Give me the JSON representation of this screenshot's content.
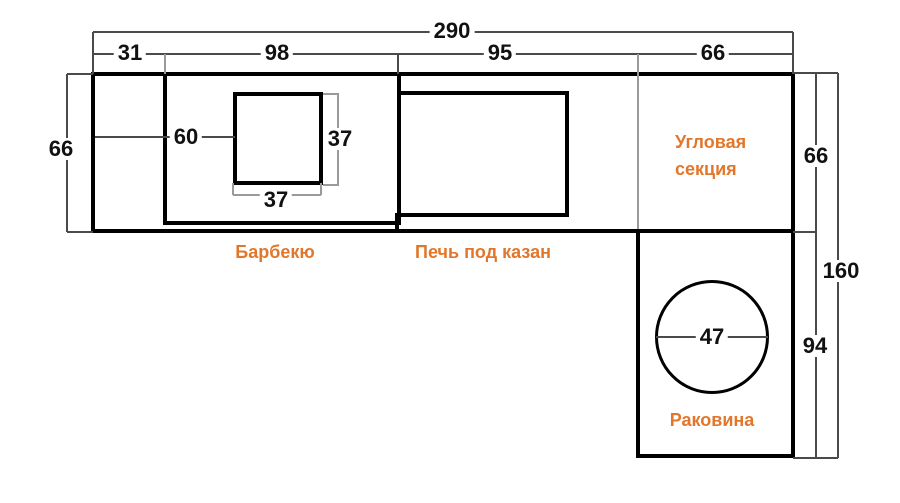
{
  "diagram": {
    "kind": "outdoor-kitchen-plan",
    "dims": {
      "total_width": "290",
      "left_section_width": "31",
      "barbecue_width": "98",
      "stove_width": "95",
      "corner_width": "66",
      "counter_depth": "66",
      "hole_offset_from_left": "60",
      "hole_side_vertical": "37",
      "hole_side_horizontal": "37",
      "corner_depth": "66",
      "right_total_height": "160",
      "sink_section_height": "94",
      "sink_hole_diameter": "47"
    },
    "labels": {
      "barbecue": "Барбекю",
      "stove": "Печь под казан",
      "corner_line1": "Угловая",
      "corner_line2": "секция",
      "sink": "Раковина"
    },
    "colors": {
      "accent_orange": "#E2772B",
      "structure_black": "#000000",
      "dim_line_dark": "#4a4a4a",
      "dim_line_gray": "#9a9a9a"
    }
  }
}
